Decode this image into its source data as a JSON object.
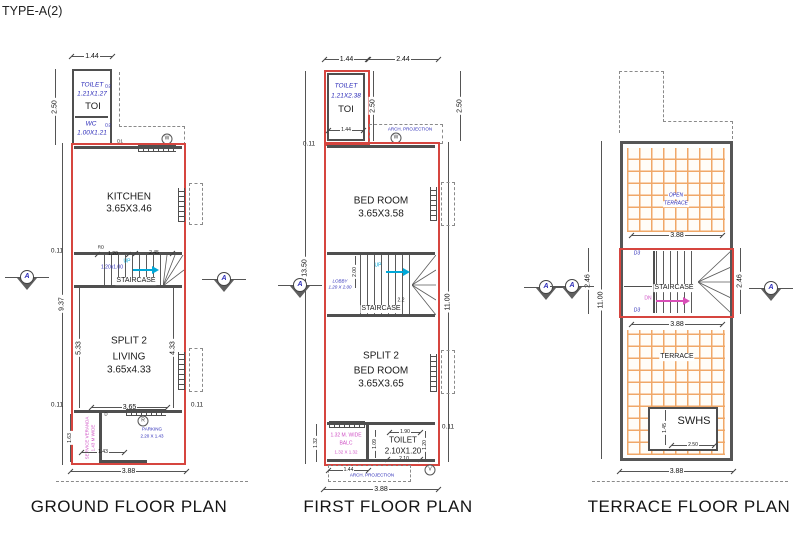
{
  "meta": {
    "type_label": "TYPE-A(2)",
    "section_marker": "A"
  },
  "colors": {
    "outline": "#d6453f",
    "wall": "#4f4f4f",
    "room_dim_blue": "#2b2bb8",
    "accent_magenta": "#cf4fc4",
    "accent_cyan": "#00a8d8",
    "tile_orange": "#f0a868"
  },
  "ground": {
    "title": "GROUND FLOOR PLAN",
    "rooms": {
      "toilet_name": "TOILET",
      "toilet_size": "1.21X1.27",
      "toi": "TOI",
      "wc_name": "WC",
      "wc_size": "1.00X1.21",
      "kitchen_name": "KITCHEN",
      "kitchen_size": "3.65X3.46",
      "staircase": "STAIRCASE",
      "up": "UP",
      "stair_size": "1.20x1.00",
      "split": "SPLIT 2",
      "living": "LIVING",
      "living_size": "3.65x4.33",
      "veranda_line1": "SERVICE VERANDA",
      "veranda_line2": "1.43 M WIDE",
      "parking_name": "PARKING",
      "parking_size": "2.20 X 1.43"
    },
    "doors": {
      "d1": "D1",
      "d2a": "D2",
      "d2b": "D2",
      "d": "D",
      "rd": "RD"
    },
    "marks": {
      "w": "W",
      "r": "R"
    },
    "dims": {
      "top": "1.44",
      "toilet_h": "2.50",
      "wall": "0.11",
      "total_left": "9.37",
      "stair_a": "1.20",
      "stair_b": "2.45",
      "living_l": "5.33",
      "living_r": "4.33",
      "bottom_inner": "3.65",
      "veranda_h": "1.63",
      "veranda_w": "1.43",
      "total_bottom": "3.88"
    }
  },
  "first": {
    "title": "FIRST FLOOR PLAN",
    "arch_projection": "ARCH. PROJECTION",
    "rooms": {
      "toilet_name": "TOILET",
      "toilet_size": "1.21X2.38",
      "toi": "TOI",
      "bed1_name": "BED ROOM",
      "bed1_size": "3.65X3.58",
      "staircase": "STAIRCASE",
      "up": "UP",
      "lobby": "LOBBY",
      "lobby_size": "1.20 X 2.00",
      "split": "SPLIT 2",
      "bed2_name": "BED ROOM",
      "bed2_size": "3.65X3.65",
      "balc_line1": "1.32 M. WIDE",
      "balc_line2": "BALC",
      "balc_size": "1.32 X 1.32",
      "toilet2_name": "TOILET",
      "toilet2_size": "2.10X1.20"
    },
    "marks": {
      "w": "W",
      "v": "V"
    },
    "dims": {
      "top_a": "1.44",
      "top_b": "2.44",
      "toilet_h": "2.50",
      "wall": "0.11",
      "toilet_w": "1.44",
      "total_left": "13.50",
      "total_right": "11.00",
      "stair_h": "2.00",
      "stair_w": "2.2",
      "t_top": "1.90",
      "t_l": "1.09",
      "t_r": "1.20",
      "t_b": "2.10",
      "balc_l": "1.32",
      "bottom_a": "1.44",
      "total_bottom": "3.88"
    }
  },
  "terrace": {
    "title": "TERRACE FLOOR PLAN",
    "rooms": {
      "open1": "OPEN",
      "open2": "TERRACE",
      "staircase": "STAIRCASE",
      "dn": "DN",
      "terrace": "TERRACE",
      "swhs": "SWHS"
    },
    "doors": {
      "d3a": "D3",
      "d3b": "D3"
    },
    "dims": {
      "w": "3.88",
      "stair_side": "2.46",
      "total_left": "11.00",
      "swhs_h": "1.45",
      "swhs_w": "2.50",
      "total_bottom": "3.88"
    }
  }
}
